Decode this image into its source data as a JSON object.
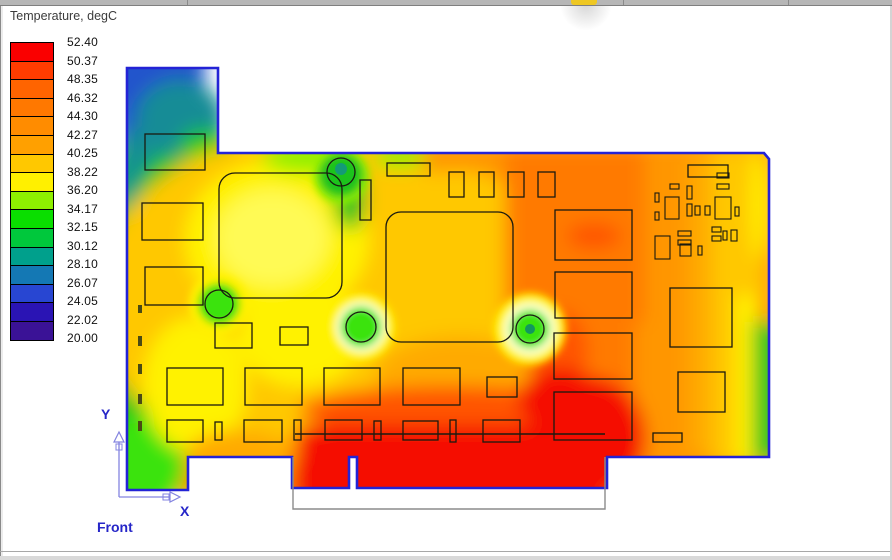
{
  "legend": {
    "title": "Temperature, degC",
    "tick_labels": [
      "52.40",
      "50.37",
      "48.35",
      "46.32",
      "44.30",
      "42.27",
      "40.25",
      "38.22",
      "36.20",
      "34.17",
      "32.15",
      "30.12",
      "28.10",
      "26.07",
      "24.05",
      "22.02",
      "20.00"
    ],
    "band_colors": [
      "#FA0000",
      "#FF3C00",
      "#FF6400",
      "#FF7800",
      "#FF8C00",
      "#FFA000",
      "#FFC800",
      "#FFF000",
      "#8EF000",
      "#0ADE00",
      "#00C83C",
      "#00A08C",
      "#1478B4",
      "#2846D2",
      "#2A14B4",
      "#3A1296"
    ]
  },
  "triad": {
    "y_label": "Y",
    "x_label": "X",
    "view_label": "Front"
  },
  "palette": {
    "board_edge": "#2323D6",
    "blue": "#2055CC",
    "teal": "#128C96",
    "green": "#1EC31E",
    "brightGreen": "#3BE30B",
    "yellowGreen": "#8EF000",
    "yellow": "#FFF200",
    "lightYellow": "#FFFA55",
    "gold": "#FFC800",
    "amber": "#FFAA00",
    "orange": "#FF9600",
    "darkOrange": "#FF7A00",
    "redOrange": "#FF5400",
    "red": "#F50800",
    "paleHalo": "#FBFFC8",
    "circleGreen": "#2BCC1A",
    "circleTeal": "#12965F",
    "axis_line": "#8484E0",
    "axis_label": "#2626C8",
    "connector_outline": "#8C8C8C",
    "dash": "#4A4A14"
  },
  "chart_data": {
    "type": "heatmap",
    "title": "Temperature, degC",
    "units": "degC",
    "scale_min": 20.0,
    "scale_max": 52.4,
    "legend_levels": [
      52.4,
      50.37,
      48.35,
      46.32,
      44.3,
      42.27,
      40.25,
      38.22,
      36.2,
      34.17,
      32.15,
      30.12,
      28.1,
      26.07,
      24.05,
      22.02,
      20.0
    ],
    "legend_position": "top-left",
    "description": "Surface temperature contour plot of a PCIe add-in card (front view). Cool blue/teal region at the top of the rear bracket, green along the left edge and mounting holes, yellow around the left heat-sink outline, orange across the right half, and a red hot zone (~52 degC) along the bottom edge-connector region.",
    "regions": [
      {
        "area": "bracket-top-left",
        "approx_degC": 24
      },
      {
        "area": "bracket-lower",
        "approx_degC": 30
      },
      {
        "area": "left-edge-column",
        "approx_degC": 32
      },
      {
        "area": "left-heatsink-outline-center",
        "approx_degC": 37.5
      },
      {
        "area": "center-heatsink-outline",
        "approx_degC": 39.5
      },
      {
        "area": "mounting-hole-spots",
        "approx_degC": 32
      },
      {
        "area": "right-mid-component-column",
        "approx_degC": 45
      },
      {
        "area": "hotspot-in-upper-right-component",
        "approx_degC": 47
      },
      {
        "area": "right-edge-cool-band",
        "approx_degC": 34
      },
      {
        "area": "bottom-edge-connector",
        "approx_degC": 52.4
      }
    ]
  }
}
